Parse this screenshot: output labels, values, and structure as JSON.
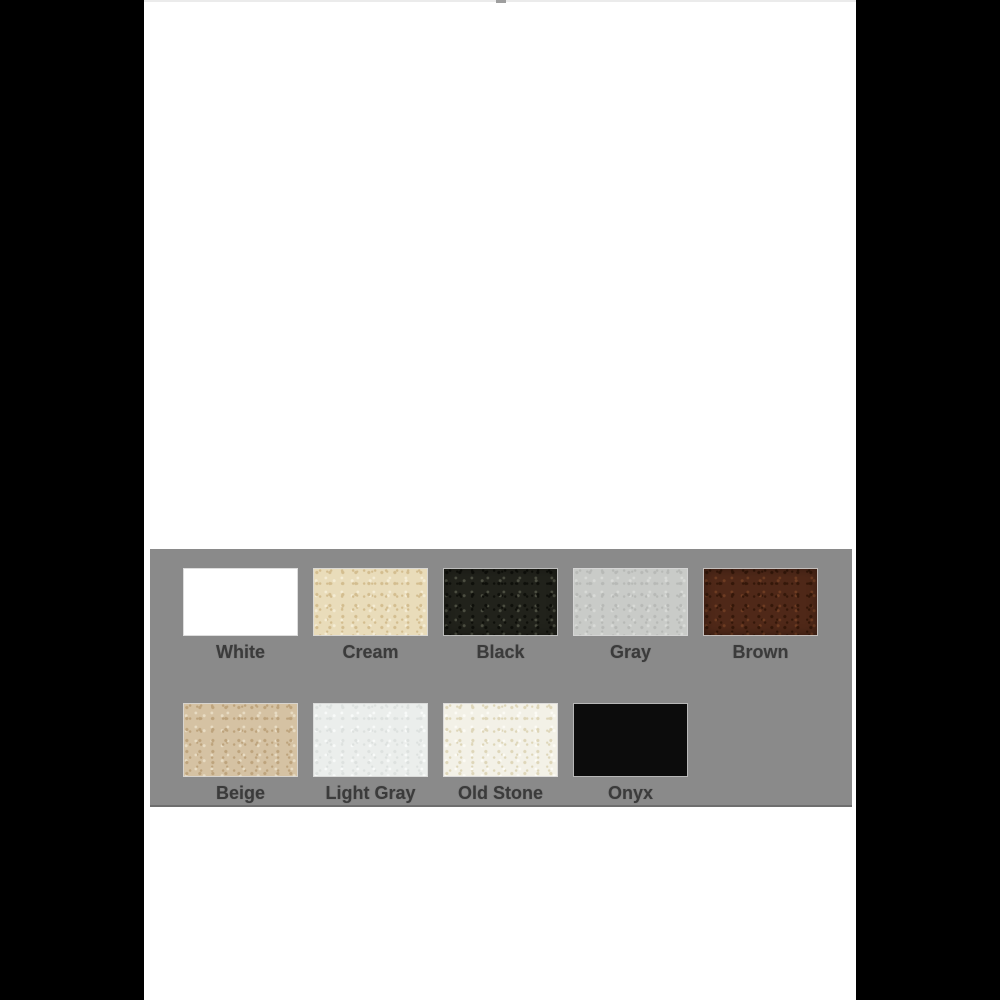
{
  "page": {
    "background_color": "#000000",
    "content_background_color": "#ffffff",
    "top_line_color": "#ebebeb"
  },
  "palette_panel": {
    "background_color": "#8a8a8a",
    "bottom_edge_color": "#6e6e6e",
    "label_color": "#3b3b3b",
    "rows": [
      {
        "swatches": [
          {
            "label": "White",
            "color": "#ffffff",
            "texture": "solid"
          },
          {
            "label": "Cream",
            "color": "#e9dcba",
            "texture": "granite",
            "speckle_dark": "#d3bd8f",
            "speckle_light": "#f4ecd4"
          },
          {
            "label": "Black",
            "color": "#21221b",
            "texture": "granite",
            "speckle_dark": "#0e0f0a",
            "speckle_light": "#4c4e41",
            "shaded": true
          },
          {
            "label": "Gray",
            "color": "#c9cbc8",
            "texture": "granite",
            "speckle_dark": "#b7b9b6",
            "speckle_light": "#d8dad7"
          },
          {
            "label": "Brown",
            "color": "#4f2818",
            "texture": "granite",
            "speckle_dark": "#341709",
            "speckle_light": "#6e3c22",
            "shaded": true
          }
        ]
      },
      {
        "swatches": [
          {
            "label": "Beige",
            "color": "#d5c2a3",
            "texture": "granite",
            "speckle_dark": "#bda37c",
            "speckle_light": "#e8dcc4"
          },
          {
            "label": "Light Gray",
            "color": "#ebeeec",
            "texture": "granite",
            "speckle_dark": "#dde1df",
            "speckle_light": "#f8faf9"
          },
          {
            "label": "Old Stone",
            "color": "#f3f1e7",
            "texture": "granite",
            "speckle_dark": "#ded6b9",
            "speckle_light": "#fcfbf5"
          },
          {
            "label": "Onyx",
            "color": "#0c0c0c",
            "texture": "solid"
          }
        ]
      }
    ]
  }
}
